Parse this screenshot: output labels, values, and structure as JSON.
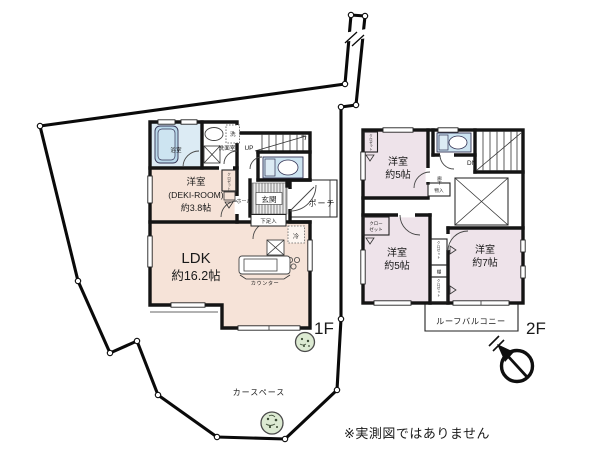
{
  "note": "※実測図ではありません",
  "site": {
    "car_space": "カースペース"
  },
  "floor1": {
    "label": "1F",
    "ldk_name": "LDK",
    "ldk_size": "約16.2帖",
    "deki_l1": "洋室",
    "deki_l2": "(DEKI-ROOM)",
    "deki_l3": "約3.8帖",
    "bath": "浴室",
    "wash_room": "洗面室",
    "washer": "洗",
    "hall": "ホール",
    "genkan": "玄関",
    "shoe_box": "下足入",
    "porch": "ポーチ",
    "stairs_up": "UP",
    "fridge": "冷",
    "counter": "カウンター",
    "closet_v": "クロゼット"
  },
  "floor2": {
    "label": "2F",
    "room5_name": "洋室",
    "room5_size": "約5帖",
    "room7_name": "洋室",
    "room7_size": "約7帖",
    "balcony": "ルーフバルコニー",
    "stairs_dn": "DN",
    "corridor": "廊下",
    "storage": "物入",
    "closet_l1": "クロー",
    "closet_l2": "ゼット",
    "closet_v": "クロゼット",
    "shelf": "棚"
  },
  "colors": {
    "room_1f": "#f6e3d8",
    "room_2f": "#eee3ea",
    "wet_blue": "#cde4f1",
    "tub_blue": "#b9d8ea",
    "wall": "#141414",
    "tree_green": "#dcead2"
  }
}
